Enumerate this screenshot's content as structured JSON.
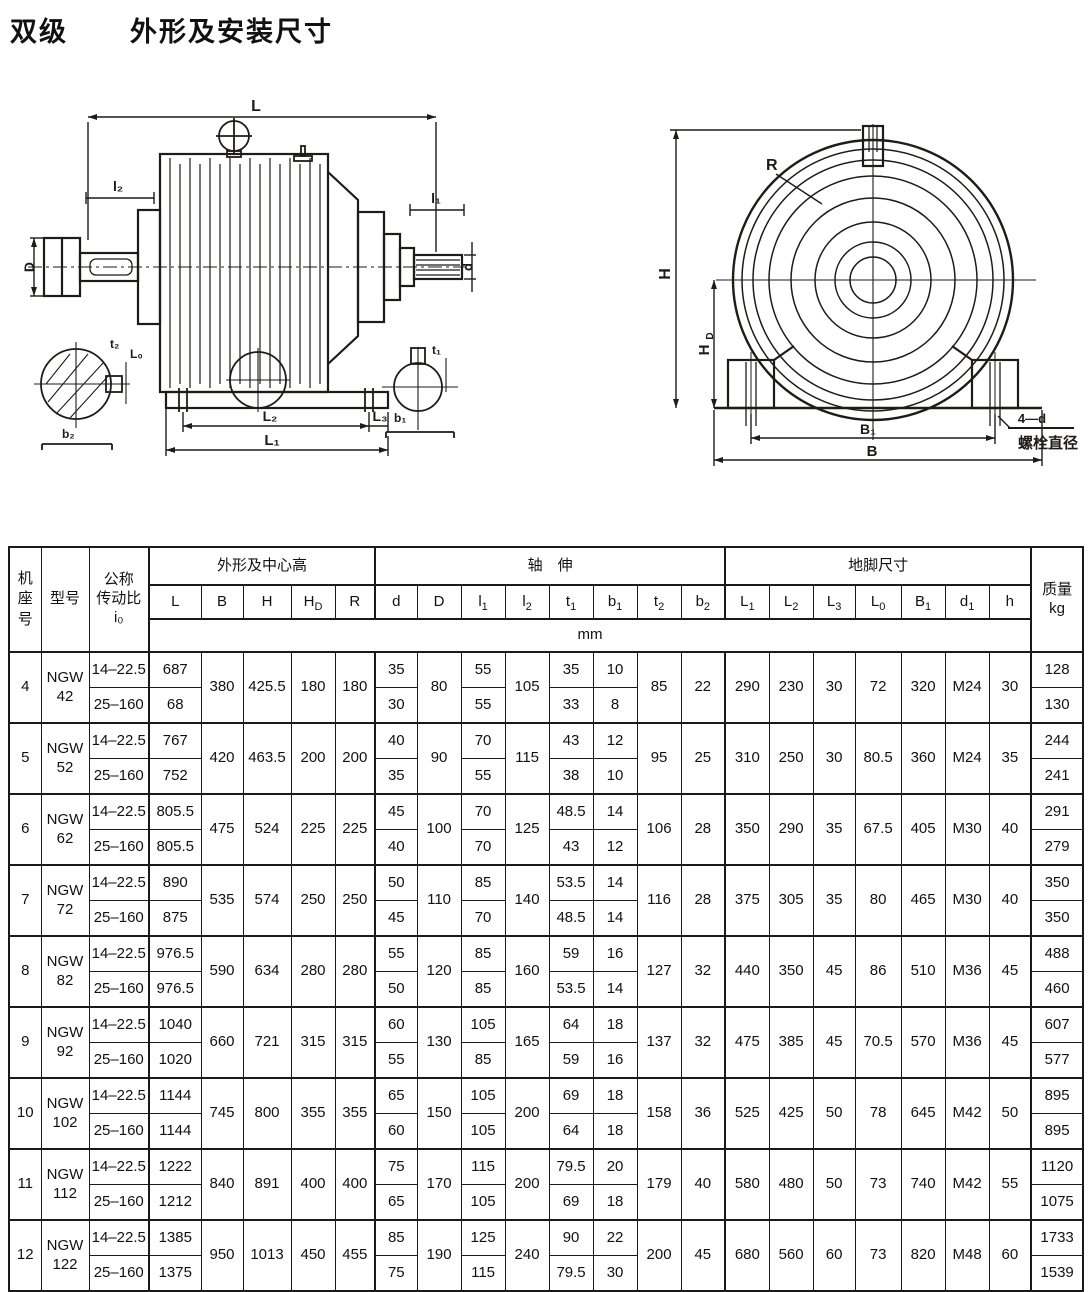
{
  "page": {
    "title_left": "双级",
    "title_right": "外形及安装尺寸"
  },
  "drawings": {
    "side_view": {
      "length": "L",
      "shaft_dia_left": "D",
      "shaft_len_left": "l₂",
      "shaft_len_right": "l₁",
      "shaft_dia_right": "d",
      "foot_offset": "L₀",
      "foot_spacing": "L₂",
      "foot_edge": "L₃",
      "foot_length": "L₁",
      "key_depth_low": "t₂",
      "key_width_low": "b₂",
      "key_depth_high": "t₁",
      "key_width_high": "b₁"
    },
    "front_view": {
      "radius": "R",
      "height": "H",
      "center_height_main": "H",
      "center_height_sub": "D",
      "foot_bolt_span": "B₁",
      "width": "B",
      "bolt_note": "4—d",
      "bolt_note_caption": "螺栓直径"
    }
  },
  "table": {
    "headers": {
      "frame_no": "机座号",
      "model": "型号",
      "ratio_label_1": "公称",
      "ratio_label_2": "传动比",
      "ratio_symbol": "i₀",
      "group_outline": "外形及中心高",
      "group_shaft": "轴　伸",
      "group_foot": "地脚尺寸",
      "mass_label": "质量",
      "mass_unit": "kg",
      "unit_row": "mm"
    },
    "columns": [
      {
        "m": "L"
      },
      {
        "m": "B"
      },
      {
        "m": "H"
      },
      {
        "m": "H",
        "s": "D"
      },
      {
        "m": "R"
      },
      {
        "m": "d"
      },
      {
        "m": "D"
      },
      {
        "m": "l",
        "s": "1"
      },
      {
        "m": "l",
        "s": "2"
      },
      {
        "m": "t",
        "s": "1"
      },
      {
        "m": "b",
        "s": "1"
      },
      {
        "m": "t",
        "s": "2"
      },
      {
        "m": "b",
        "s": "2"
      },
      {
        "m": "L",
        "s": "1"
      },
      {
        "m": "L",
        "s": "2"
      },
      {
        "m": "L",
        "s": "3"
      },
      {
        "m": "L",
        "s": "0"
      },
      {
        "m": "B",
        "s": "1"
      },
      {
        "m": "d",
        "s": "1"
      },
      {
        "m": "h"
      }
    ],
    "machines": [
      {
        "no": "4",
        "model": [
          "NGW",
          "42"
        ],
        "shared": {
          "B": "380",
          "H": "425.5",
          "HD": "180",
          "R": "180",
          "D": "80",
          "l2": "105",
          "t2": "85",
          "b2": "22",
          "L1": "290",
          "L2": "230",
          "L3": "30",
          "L0": "72",
          "B1": "320",
          "d1": "M24",
          "h": "30"
        },
        "rows": [
          {
            "ratio": "14–22.5",
            "L": "687",
            "d": "35",
            "l1": "55",
            "t1": "35",
            "b1": "10",
            "kg": "128"
          },
          {
            "ratio": "25–160",
            "L": "68",
            "d": "30",
            "l1": "55",
            "t1": "33",
            "b1": "8",
            "kg": "130"
          }
        ]
      },
      {
        "no": "5",
        "model": [
          "NGW",
          "52"
        ],
        "shared": {
          "B": "420",
          "H": "463.5",
          "HD": "200",
          "R": "200",
          "D": "90",
          "l2": "115",
          "t2": "95",
          "b2": "25",
          "L1": "310",
          "L2": "250",
          "L3": "30",
          "L0": "80.5",
          "B1": "360",
          "d1": "M24",
          "h": "35"
        },
        "rows": [
          {
            "ratio": "14–22.5",
            "L": "767",
            "d": "40",
            "l1": "70",
            "t1": "43",
            "b1": "12",
            "kg": "244"
          },
          {
            "ratio": "25–160",
            "L": "752",
            "d": "35",
            "l1": "55",
            "t1": "38",
            "b1": "10",
            "kg": "241"
          }
        ]
      },
      {
        "no": "6",
        "model": [
          "NGW",
          "62"
        ],
        "shared": {
          "B": "475",
          "H": "524",
          "HD": "225",
          "R": "225",
          "D": "100",
          "l2": "125",
          "t2": "106",
          "b2": "28",
          "L1": "350",
          "L2": "290",
          "L3": "35",
          "L0": "67.5",
          "B1": "405",
          "d1": "M30",
          "h": "40"
        },
        "rows": [
          {
            "ratio": "14–22.5",
            "L": "805.5",
            "d": "45",
            "l1": "70",
            "t1": "48.5",
            "b1": "14",
            "kg": "291"
          },
          {
            "ratio": "25–160",
            "L": "805.5",
            "d": "40",
            "l1": "70",
            "t1": "43",
            "b1": "12",
            "kg": "279"
          }
        ]
      },
      {
        "no": "7",
        "model": [
          "NGW",
          "72"
        ],
        "shared": {
          "B": "535",
          "H": "574",
          "HD": "250",
          "R": "250",
          "D": "110",
          "l2": "140",
          "t2": "116",
          "b2": "28",
          "L1": "375",
          "L2": "305",
          "L3": "35",
          "L0": "80",
          "B1": "465",
          "d1": "M30",
          "h": "40"
        },
        "rows": [
          {
            "ratio": "14–22.5",
            "L": "890",
            "d": "50",
            "l1": "85",
            "t1": "53.5",
            "b1": "14",
            "kg": "350"
          },
          {
            "ratio": "25–160",
            "L": "875",
            "d": "45",
            "l1": "70",
            "t1": "48.5",
            "b1": "14",
            "kg": "350"
          }
        ]
      },
      {
        "no": "8",
        "model": [
          "NGW",
          "82"
        ],
        "shared": {
          "B": "590",
          "H": "634",
          "HD": "280",
          "R": "280",
          "D": "120",
          "l2": "160",
          "t2": "127",
          "b2": "32",
          "L1": "440",
          "L2": "350",
          "L3": "45",
          "L0": "86",
          "B1": "510",
          "d1": "M36",
          "h": "45"
        },
        "rows": [
          {
            "ratio": "14–22.5",
            "L": "976.5",
            "d": "55",
            "l1": "85",
            "t1": "59",
            "b1": "16",
            "kg": "488"
          },
          {
            "ratio": "25–160",
            "L": "976.5",
            "d": "50",
            "l1": "85",
            "t1": "53.5",
            "b1": "14",
            "kg": "460"
          }
        ]
      },
      {
        "no": "9",
        "model": [
          "NGW",
          "92"
        ],
        "shared": {
          "B": "660",
          "H": "721",
          "HD": "315",
          "R": "315",
          "D": "130",
          "l2": "165",
          "t2": "137",
          "b2": "32",
          "L1": "475",
          "L2": "385",
          "L3": "45",
          "L0": "70.5",
          "B1": "570",
          "d1": "M36",
          "h": "45"
        },
        "rows": [
          {
            "ratio": "14–22.5",
            "L": "1040",
            "d": "60",
            "l1": "105",
            "t1": "64",
            "b1": "18",
            "kg": "607"
          },
          {
            "ratio": "25–160",
            "L": "1020",
            "d": "55",
            "l1": "85",
            "t1": "59",
            "b1": "16",
            "kg": "577"
          }
        ]
      },
      {
        "no": "10",
        "model": [
          "NGW",
          "102"
        ],
        "shared": {
          "B": "745",
          "H": "800",
          "HD": "355",
          "R": "355",
          "D": "150",
          "l2": "200",
          "t2": "158",
          "b2": "36",
          "L1": "525",
          "L2": "425",
          "L3": "50",
          "L0": "78",
          "B1": "645",
          "d1": "M42",
          "h": "50"
        },
        "rows": [
          {
            "ratio": "14–22.5",
            "L": "1144",
            "d": "65",
            "l1": "105",
            "t1": "69",
            "b1": "18",
            "kg": "895"
          },
          {
            "ratio": "25–160",
            "L": "1144",
            "d": "60",
            "l1": "105",
            "t1": "64",
            "b1": "18",
            "kg": "895"
          }
        ]
      },
      {
        "no": "11",
        "model": [
          "NGW",
          "112"
        ],
        "shared": {
          "B": "840",
          "H": "891",
          "HD": "400",
          "R": "400",
          "D": "170",
          "l2": "200",
          "t2": "179",
          "b2": "40",
          "L1": "580",
          "L2": "480",
          "L3": "50",
          "L0": "73",
          "B1": "740",
          "d1": "M42",
          "h": "55"
        },
        "rows": [
          {
            "ratio": "14–22.5",
            "L": "1222",
            "d": "75",
            "l1": "115",
            "t1": "79.5",
            "b1": "20",
            "kg": "1120"
          },
          {
            "ratio": "25–160",
            "L": "1212",
            "d": "65",
            "l1": "105",
            "t1": "69",
            "b1": "18",
            "kg": "1075"
          }
        ]
      },
      {
        "no": "12",
        "model": [
          "NGW",
          "122"
        ],
        "shared": {
          "B": "950",
          "H": "1013",
          "HD": "450",
          "R": "455",
          "D": "190",
          "l2": "240",
          "t2": "200",
          "b2": "45",
          "L1": "680",
          "L2": "560",
          "L3": "60",
          "L0": "73",
          "B1": "820",
          "d1": "M48",
          "h": "60"
        },
        "rows": [
          {
            "ratio": "14–22.5",
            "L": "1385",
            "d": "85",
            "l1": "125",
            "t1": "90",
            "b1": "22",
            "kg": "1733"
          },
          {
            "ratio": "25–160",
            "L": "1375",
            "d": "75",
            "l1": "115",
            "t1": "79.5",
            "b1": "30",
            "kg": "1539"
          }
        ]
      }
    ]
  }
}
